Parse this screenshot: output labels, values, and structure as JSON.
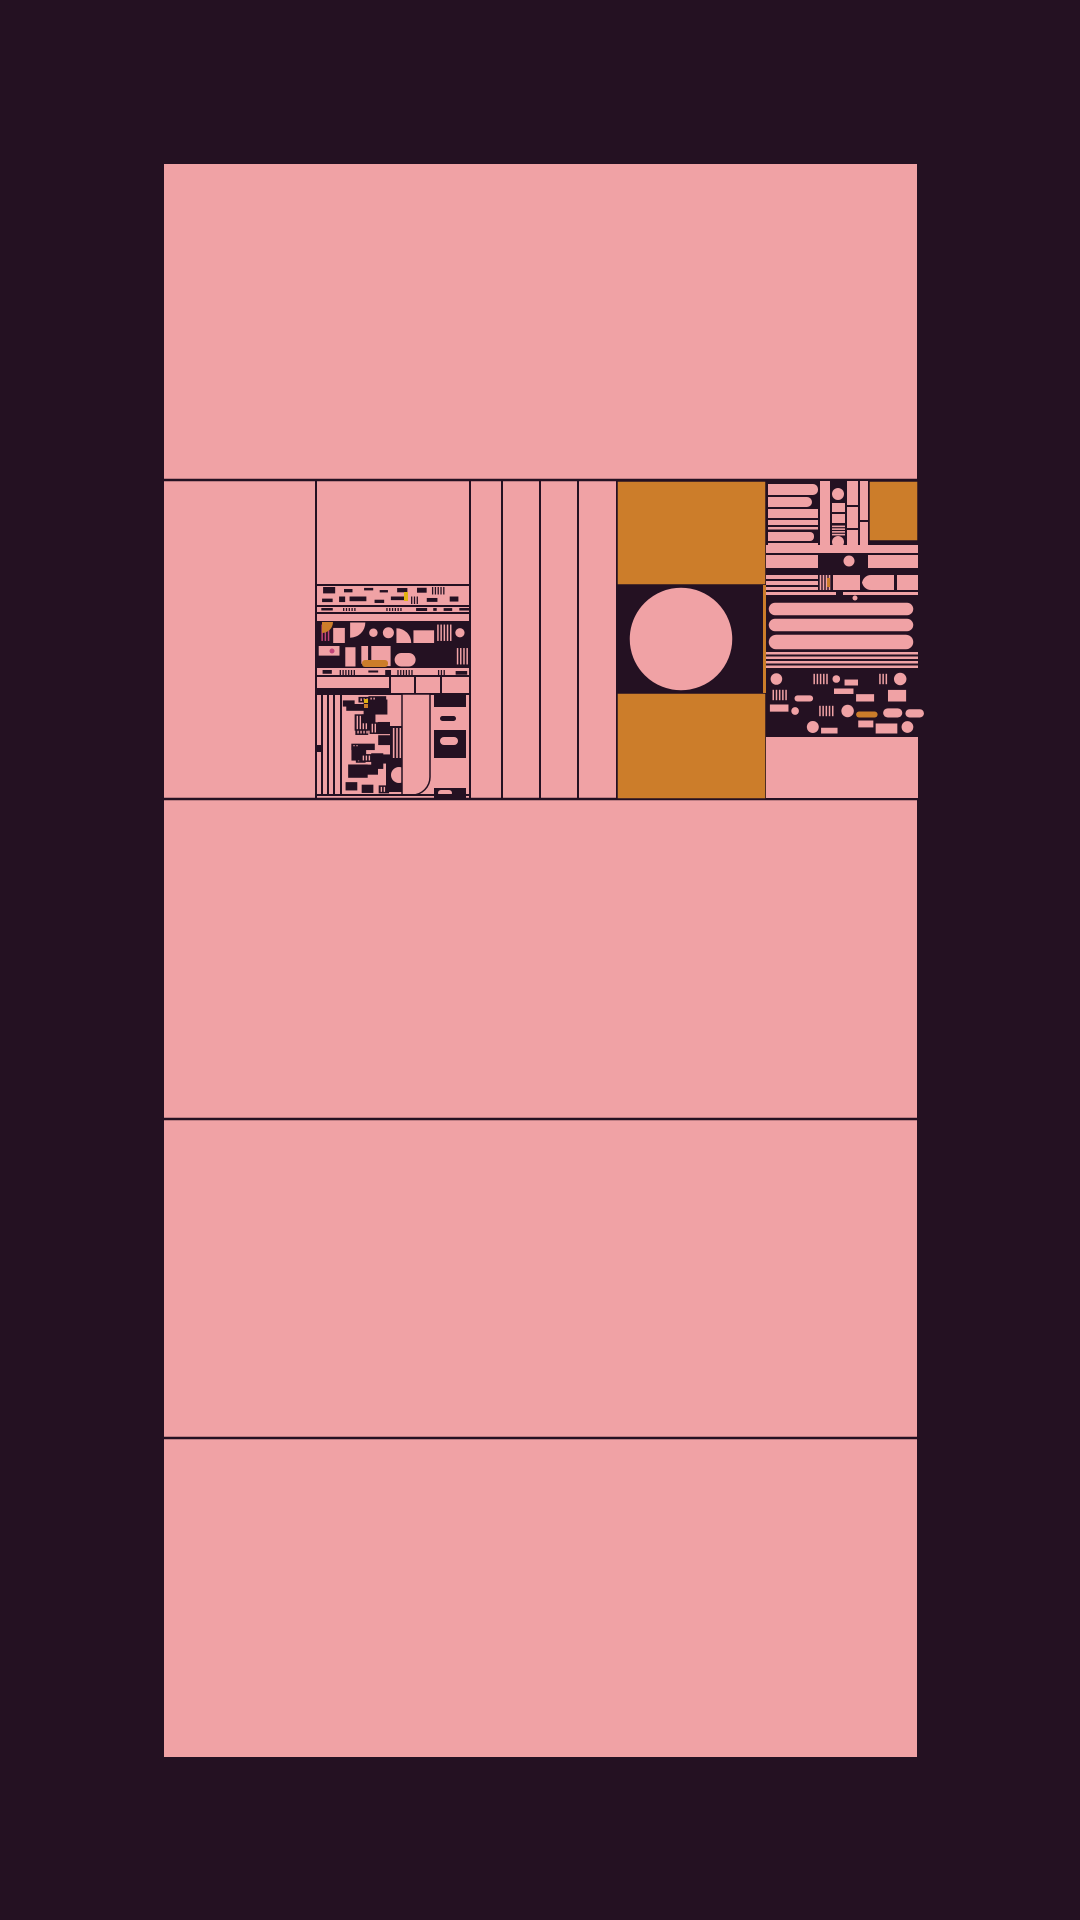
{
  "artwork": {
    "kind": "abstract-generative-composition",
    "canvas": {
      "width": 1080,
      "height": 1920
    },
    "palette": {
      "background": "#241122",
      "dark": "#241122",
      "pink": "#F0A2A5",
      "orange": "#CC7D2A",
      "yellow": "#E2B214",
      "magenta": "#C24478",
      "line": "#241122"
    },
    "structure": {
      "panel": {
        "x": 163,
        "y": 163,
        "w": 755,
        "h": 1595
      },
      "band_lines_y": [
        480,
        799,
        1119,
        1438
      ],
      "detail_band": {
        "top": 480,
        "bottom": 799
      },
      "detail_vlines_x": [
        316,
        470,
        502,
        540,
        578,
        617,
        766
      ]
    },
    "regions": [
      {
        "name": "left-mosaic",
        "elems": [
          {
            "t": "line",
            "x1": 316,
            "y1": 585,
            "x2": 470,
            "y2": 585
          },
          {
            "t": "tex",
            "style": "inv",
            "x": 316,
            "y": 586,
            "w": 154,
            "h": 19,
            "seed": 11,
            "rowH": 9
          },
          {
            "t": "rect",
            "x": 404,
            "y": 592,
            "w": 4,
            "h": 9,
            "f": "yellow"
          },
          {
            "t": "line",
            "x1": 316,
            "y1": 606,
            "x2": 470,
            "y2": 606
          },
          {
            "t": "tex",
            "style": "inv",
            "x": 316,
            "y": 607,
            "w": 154,
            "h": 5,
            "seed": 12,
            "rowH": 5
          },
          {
            "t": "line",
            "x1": 316,
            "y1": 613,
            "x2": 470,
            "y2": 613
          },
          {
            "t": "tex",
            "style": "dark",
            "x": 316,
            "y": 621,
            "w": 154,
            "h": 47,
            "seed": 13,
            "rowH": 23
          },
          {
            "t": "quarter",
            "x": 322,
            "y": 622,
            "r": 11,
            "f": "orange"
          },
          {
            "t": "circle",
            "cx": 332,
            "cy": 651,
            "r": 2.5,
            "f": "magenta"
          },
          {
            "t": "rect",
            "x": 362,
            "y": 660,
            "w": 26,
            "h": 7,
            "rx": 3,
            "f": "orange"
          },
          {
            "t": "tex",
            "style": "inv",
            "x": 316,
            "y": 669,
            "w": 154,
            "h": 7,
            "seed": 14,
            "rowH": 7
          },
          {
            "t": "line",
            "x1": 316,
            "y1": 676,
            "x2": 470,
            "y2": 676
          },
          {
            "t": "line",
            "x1": 390,
            "y1": 676,
            "x2": 390,
            "y2": 694
          },
          {
            "t": "line",
            "x1": 415,
            "y1": 676,
            "x2": 415,
            "y2": 694
          },
          {
            "t": "line",
            "x1": 441,
            "y1": 676,
            "x2": 441,
            "y2": 694
          },
          {
            "t": "rect",
            "x": 316,
            "y": 688,
            "w": 74,
            "h": 5,
            "f": "dark"
          },
          {
            "t": "line",
            "x1": 316,
            "y1": 694,
            "x2": 470,
            "y2": 694
          },
          {
            "t": "line",
            "x1": 322,
            "y1": 694,
            "x2": 322,
            "y2": 795
          },
          {
            "t": "line",
            "x1": 328,
            "y1": 694,
            "x2": 328,
            "y2": 795
          },
          {
            "t": "line",
            "x1": 334,
            "y1": 694,
            "x2": 334,
            "y2": 795
          },
          {
            "t": "line",
            "x1": 341,
            "y1": 694,
            "x2": 341,
            "y2": 795
          },
          {
            "t": "rect",
            "x": 316,
            "y": 745,
            "w": 7,
            "h": 7,
            "f": "dark"
          },
          {
            "t": "tex",
            "style": "patch",
            "x": 342,
            "y": 695,
            "w": 48,
            "h": 100,
            "seed": 15
          },
          {
            "t": "rect",
            "x": 364,
            "y": 699,
            "w": 4,
            "h": 4,
            "f": "yellow"
          },
          {
            "t": "rect",
            "x": 364,
            "y": 704,
            "w": 4,
            "h": 4,
            "f": "orange"
          },
          {
            "t": "rect",
            "x": 390,
            "y": 726,
            "w": 13,
            "h": 50,
            "f": "dark"
          },
          {
            "t": "vlines",
            "x": 392,
            "y": 728,
            "w": 10,
            "h": 46,
            "n": 3,
            "f": "pink"
          },
          {
            "t": "rect",
            "x": 386,
            "y": 758,
            "w": 32,
            "h": 34,
            "f": "dark"
          },
          {
            "t": "circle",
            "cx": 399,
            "cy": 775,
            "r": 8,
            "f": "pink"
          },
          {
            "t": "rect",
            "x": 402,
            "y": 694,
            "w": 28,
            "h": 101,
            "corners": [
              0,
              0,
              18,
              0
            ],
            "f": "pink",
            "s": true
          },
          {
            "t": "rect",
            "x": 434,
            "y": 694,
            "w": 32,
            "h": 13,
            "f": "dark"
          },
          {
            "t": "rect",
            "x": 440,
            "y": 716,
            "w": 16,
            "h": 5,
            "rx": 2.5,
            "f": "dark"
          },
          {
            "t": "rect",
            "x": 434,
            "y": 730,
            "w": 32,
            "h": 28,
            "f": "dark"
          },
          {
            "t": "rect",
            "x": 440,
            "y": 737,
            "w": 18,
            "h": 8,
            "rx": 4,
            "f": "pink"
          },
          {
            "t": "rect",
            "x": 434,
            "y": 788,
            "w": 32,
            "h": 10,
            "f": "dark"
          },
          {
            "t": "rect",
            "x": 438,
            "y": 790,
            "w": 14,
            "h": 6,
            "rx": 3,
            "f": "pink"
          },
          {
            "t": "line",
            "x1": 316,
            "y1": 795,
            "x2": 470,
            "y2": 795
          }
        ]
      },
      {
        "name": "central-section",
        "elems": [
          {
            "t": "rect",
            "x": 617,
            "y": 481,
            "w": 149,
            "h": 104,
            "f": "orange",
            "s": true
          },
          {
            "t": "rect",
            "x": 617,
            "y": 585,
            "w": 149,
            "h": 108,
            "f": "dark"
          },
          {
            "t": "circle",
            "cx": 681,
            "cy": 639,
            "r": 52,
            "f": "pink",
            "s": true
          },
          {
            "t": "rect",
            "x": 617,
            "y": 693,
            "w": 149,
            "h": 106,
            "f": "orange",
            "s": true
          },
          {
            "t": "rect",
            "x": 763,
            "y": 585,
            "w": 3.5,
            "h": 108,
            "f": "orange"
          }
        ]
      },
      {
        "name": "right-section",
        "elems": [
          {
            "t": "rect",
            "x": 766,
            "y": 481,
            "w": 152,
            "h": 318,
            "f": "dark"
          },
          {
            "t": "rect",
            "x": 768,
            "y": 484,
            "w": 50,
            "h": 11,
            "corners": [
              0,
              5,
              5,
              0
            ],
            "f": "pink"
          },
          {
            "t": "rect",
            "x": 768,
            "y": 497,
            "w": 44,
            "h": 10,
            "corners": [
              0,
              5,
              5,
              0
            ],
            "f": "pink"
          },
          {
            "t": "rect",
            "x": 768,
            "y": 509,
            "w": 50,
            "h": 9,
            "f": "pink"
          },
          {
            "t": "rect",
            "x": 768,
            "y": 520,
            "w": 50,
            "h": 5,
            "f": "pink"
          },
          {
            "t": "rect",
            "x": 768,
            "y": 527,
            "w": 50,
            "h": 2.5,
            "f": "pink"
          },
          {
            "t": "rect",
            "x": 768,
            "y": 532,
            "w": 46,
            "h": 9,
            "corners": [
              0,
              4,
              4,
              0
            ],
            "f": "pink"
          },
          {
            "t": "rect",
            "x": 768,
            "y": 543,
            "w": 50,
            "h": 2,
            "f": "pink"
          },
          {
            "t": "rect",
            "x": 820,
            "y": 481,
            "w": 10,
            "h": 64,
            "f": "pink"
          },
          {
            "t": "circle",
            "cx": 838,
            "cy": 494,
            "r": 6,
            "f": "pink"
          },
          {
            "t": "rect",
            "x": 832,
            "y": 503,
            "w": 13,
            "h": 9,
            "f": "pink"
          },
          {
            "t": "rect",
            "x": 832,
            "y": 514,
            "w": 13,
            "h": 9,
            "f": "pink"
          },
          {
            "t": "hlines",
            "x": 832,
            "y": 525,
            "w": 13,
            "h": 11,
            "n": 4,
            "f": "pink"
          },
          {
            "t": "circle",
            "cx": 838,
            "cy": 542,
            "r": 6,
            "f": "pink"
          },
          {
            "t": "rect",
            "x": 847,
            "y": 481,
            "w": 11,
            "h": 24,
            "f": "pink"
          },
          {
            "t": "rect",
            "x": 847,
            "y": 507,
            "w": 11,
            "h": 21,
            "f": "pink"
          },
          {
            "t": "rect",
            "x": 847,
            "y": 530,
            "w": 11,
            "h": 15,
            "f": "pink"
          },
          {
            "t": "rect",
            "x": 860,
            "y": 481,
            "w": 8,
            "h": 39,
            "f": "pink"
          },
          {
            "t": "rect",
            "x": 860,
            "y": 522,
            "w": 8,
            "h": 23,
            "f": "pink"
          },
          {
            "t": "rect",
            "x": 869,
            "y": 481,
            "w": 49,
            "h": 60,
            "f": "orange",
            "s": true
          },
          {
            "t": "rect",
            "x": 766,
            "y": 545,
            "w": 152,
            "h": 8,
            "f": "pink"
          },
          {
            "t": "rect",
            "x": 766,
            "y": 555,
            "w": 52,
            "h": 13,
            "f": "pink"
          },
          {
            "t": "circle",
            "cx": 849,
            "cy": 561,
            "r": 5.5,
            "f": "pink"
          },
          {
            "t": "rect",
            "x": 868,
            "y": 555,
            "w": 50,
            "h": 13,
            "f": "pink"
          },
          {
            "t": "rect",
            "x": 766,
            "y": 575,
            "w": 52,
            "h": 4,
            "f": "pink"
          },
          {
            "t": "rect",
            "x": 766,
            "y": 581,
            "w": 52,
            "h": 4,
            "f": "pink"
          },
          {
            "t": "rect",
            "x": 766,
            "y": 587,
            "w": 52,
            "h": 3,
            "f": "pink"
          },
          {
            "t": "vlines",
            "x": 819,
            "y": 575,
            "w": 12,
            "h": 15,
            "n": 4,
            "f": "pink"
          },
          {
            "t": "rect",
            "x": 827,
            "y": 578,
            "w": 3,
            "h": 9,
            "f": "orange"
          },
          {
            "t": "rect",
            "x": 833,
            "y": 575,
            "w": 27,
            "h": 15,
            "f": "pink"
          },
          {
            "t": "rect",
            "x": 862,
            "y": 575,
            "w": 32,
            "h": 15,
            "corners": [
              9,
              0,
              0,
              9
            ],
            "f": "pink"
          },
          {
            "t": "rect",
            "x": 897,
            "y": 575,
            "w": 21,
            "h": 15,
            "f": "pink"
          },
          {
            "t": "rect",
            "x": 766,
            "y": 592,
            "w": 70,
            "h": 3,
            "f": "pink"
          },
          {
            "t": "rect",
            "x": 843,
            "y": 592,
            "w": 75,
            "h": 3,
            "f": "pink"
          },
          {
            "t": "circle",
            "cx": 855,
            "cy": 598,
            "r": 2.5,
            "f": "pink"
          },
          {
            "t": "rect",
            "x": 768,
            "y": 602,
            "w": 146,
            "h": 14,
            "rx": 7,
            "f": "pink",
            "s": true
          },
          {
            "t": "rect",
            "x": 768,
            "y": 618,
            "w": 146,
            "h": 14,
            "rx": 7,
            "f": "pink",
            "s": true
          },
          {
            "t": "rect",
            "x": 768,
            "y": 634,
            "w": 146,
            "h": 16,
            "rx": 8,
            "f": "pink",
            "s": true
          },
          {
            "t": "rect",
            "x": 766,
            "y": 652,
            "w": 152,
            "h": 2.5,
            "f": "pink"
          },
          {
            "t": "rect",
            "x": 766,
            "y": 656.5,
            "w": 152,
            "h": 2.5,
            "f": "pink"
          },
          {
            "t": "rect",
            "x": 766,
            "y": 661,
            "w": 152,
            "h": 2.5,
            "f": "pink"
          },
          {
            "t": "rect",
            "x": 766,
            "y": 665.5,
            "w": 152,
            "h": 2.5,
            "f": "pink"
          },
          {
            "t": "tex",
            "style": "dark",
            "x": 766,
            "y": 671,
            "w": 152,
            "h": 64,
            "seed": 21,
            "rowH": 16,
            "bgless": true
          },
          {
            "t": "rect",
            "x": 766,
            "y": 737,
            "w": 152,
            "h": 61,
            "f": "pink"
          }
        ]
      }
    ]
  }
}
